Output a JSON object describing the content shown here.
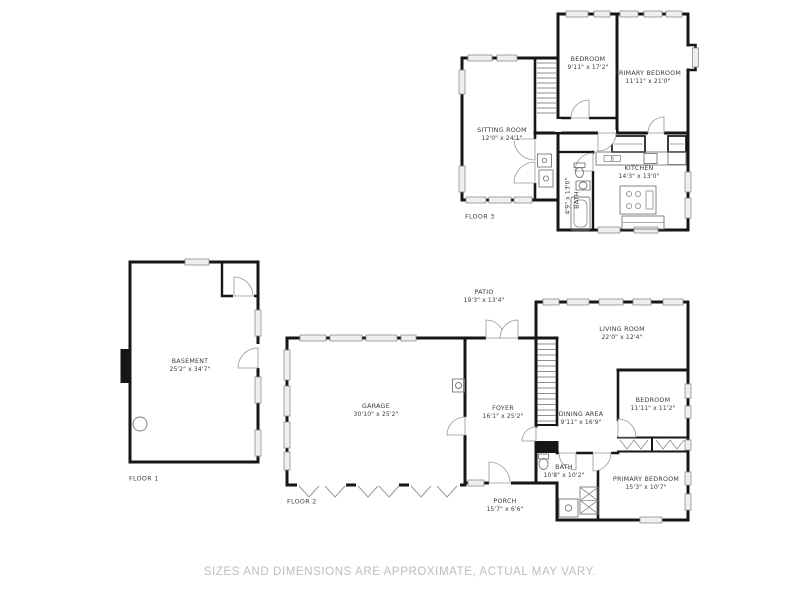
{
  "footer": {
    "disclaimer": "SIZES AND DIMENSIONS ARE APPROXIMATE, ACTUAL MAY VARY."
  },
  "colors": {
    "wall": "#161616",
    "window_fill": "#efefef",
    "label_text": "#3a3a3a",
    "footer_text": "#bdbdbd",
    "background": "#ffffff"
  },
  "floors": [
    {
      "label": "FLOOR 1",
      "rooms": {
        "basement": {
          "name": "BASEMENT",
          "dims": "25'2\" x 34'7\""
        }
      }
    },
    {
      "label": "FLOOR 2",
      "rooms": {
        "garage": {
          "name": "GARAGE",
          "dims": "30'10\" x 25'2\""
        },
        "foyer": {
          "name": "FOYER",
          "dims": "16'1\" x 25'2\""
        },
        "patio": {
          "name": "PATIO",
          "dims": "19'3\" x 13'4\""
        },
        "living_room": {
          "name": "LIVING ROOM",
          "dims": "22'0\" x 12'4\""
        },
        "dining_area": {
          "name": "DINING AREA",
          "dims": "9'11\" x 16'9\""
        },
        "bedroom": {
          "name": "BEDROOM",
          "dims": "11'11\" x 11'2\""
        },
        "bath": {
          "name": "BATH",
          "dims": "10'8\" x 10'2\""
        },
        "primary_bedroom": {
          "name": "PRIMARY BEDROOM",
          "dims": "15'3\" x 10'7\""
        },
        "porch": {
          "name": "PORCH",
          "dims": "15'7\" x 6'6\""
        }
      }
    },
    {
      "label": "FLOOR 3",
      "rooms": {
        "bedroom": {
          "name": "BEDROOM",
          "dims": "9'11\" x 17'2\""
        },
        "primary_bedroom": {
          "name": "PRIMARY BEDROOM",
          "dims": "11'11\" x 21'0\""
        },
        "sitting_room": {
          "name": "SITTING ROOM",
          "dims": "12'0\" x 24'1\""
        },
        "kitchen": {
          "name": "KITCHEN",
          "dims": "14'3\" x 13'0\""
        },
        "bath": {
          "name": "BATH",
          "dims": "4'9\" x 13'0\""
        }
      }
    }
  ]
}
